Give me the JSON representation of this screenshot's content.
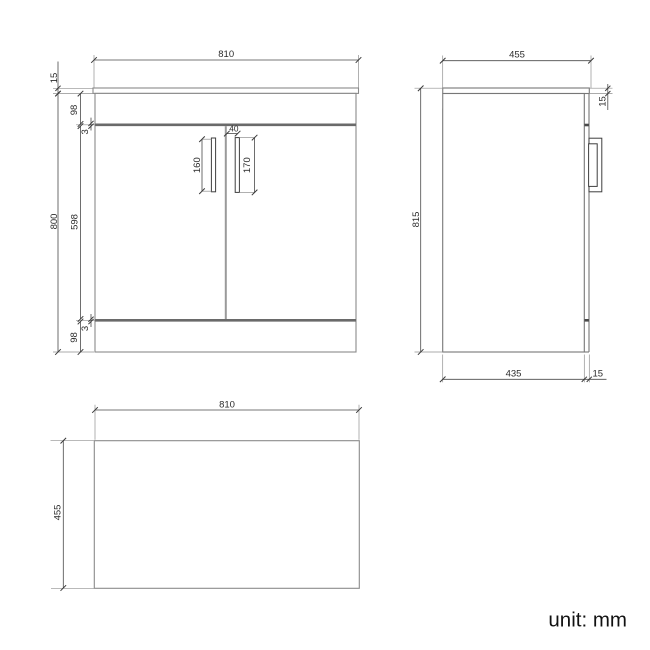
{
  "unit_label": "unit: mm",
  "palette": {
    "outline": "#8a8a8a",
    "dim_line": "#4a4a4a",
    "thick_line": "#6a6a6a",
    "text": "#2b2b2b"
  },
  "front_view": {
    "dims": {
      "overall_width": "810",
      "countertop_thickness": "15",
      "overall_height": "800",
      "top_rail_height": "98",
      "top_door_gap": "3",
      "door_height": "598",
      "bottom_door_gap": "3",
      "bottom_rail_height": "98",
      "left_handle_spacing": "160",
      "right_handle_length": "170",
      "handle_offset": "40"
    }
  },
  "side_view": {
    "dims": {
      "overall_depth": "455",
      "overall_height": "815",
      "countertop_thickness": "15",
      "carcass_depth": "435",
      "door_thickness": "15"
    }
  },
  "top_view": {
    "dims": {
      "overall_width": "810",
      "overall_depth": "455"
    }
  }
}
